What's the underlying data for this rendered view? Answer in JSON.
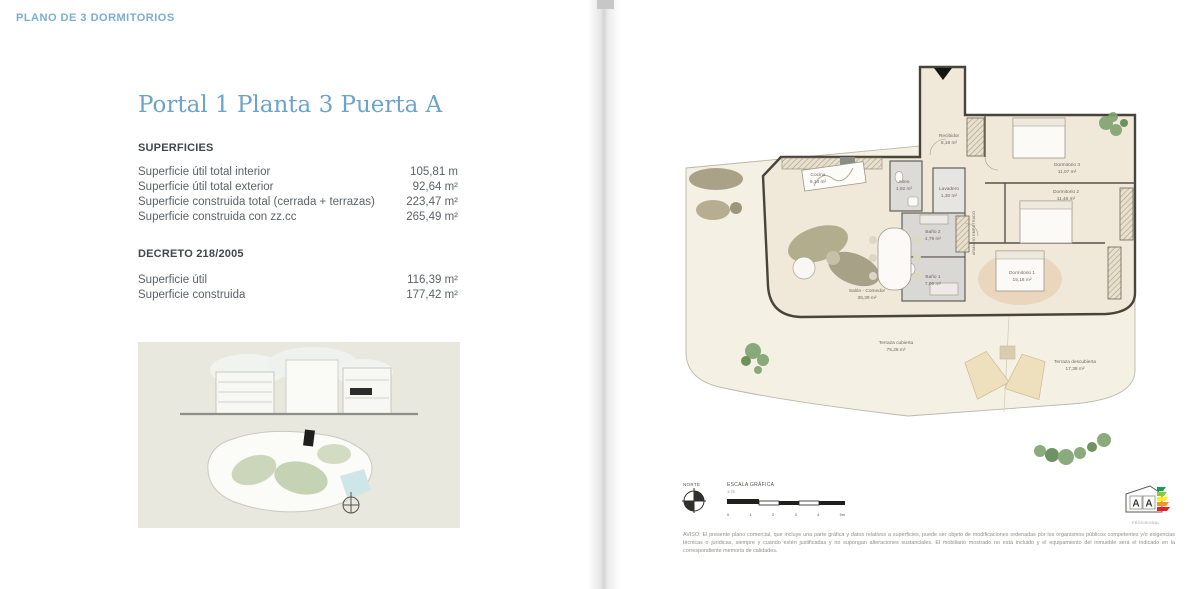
{
  "page": {
    "header": "PLANO DE 3 DORMITORIOS",
    "title": "Portal 1 Planta 3 Puerta A"
  },
  "superficies": {
    "heading": "SUPERFICIES",
    "rows": [
      {
        "label": "Superficie útil total interior",
        "value": "105,81 m"
      },
      {
        "label": "Superficie útil total exterior",
        "value": "92,64 m²"
      },
      {
        "label": "Superficie construida total (cerrada + terrazas)",
        "value": "223,47 m²"
      },
      {
        "label": "Superficie construida con zz.cc",
        "value": "265,49 m²"
      }
    ]
  },
  "decreto": {
    "heading": "DECRETO 218/2005",
    "rows": [
      {
        "label": "Superficie útil",
        "value": "116,39 m²"
      },
      {
        "label": "Superficie construida",
        "value": "177,42 m²"
      }
    ]
  },
  "plan": {
    "rooms": [
      {
        "name": "Recibidor",
        "area": "8,18 m²"
      },
      {
        "name": "Cocina",
        "area": "9,14 m²"
      },
      {
        "name": "Aseo",
        "area": "1,92 m²"
      },
      {
        "name": "Lavadero",
        "area": "1,30 m²"
      },
      {
        "name": "Baño 2",
        "area": "4,79 m²"
      },
      {
        "name": "Baño 1",
        "area": "7,06 m²"
      },
      {
        "name": "Salón - Comedor",
        "area": "35,39 m²"
      },
      {
        "name": "Dormitorio 1",
        "area": "15,16 m²"
      },
      {
        "name": "Dormitorio 2",
        "area": "11,46 m²"
      },
      {
        "name": "Dormitorio 3",
        "area": "11,07 m²"
      },
      {
        "name": "Terraza cubierta",
        "area": "75,26 m²"
      },
      {
        "name": "Terraza descubierta",
        "area": "17,38 m²"
      }
    ],
    "shaft_label": "ARMARIO EMPOTRADO"
  },
  "legend": {
    "north_label": "NORTE",
    "scale_label": "ESCALA GRÁFICA",
    "scale_ratio": "1:75",
    "scale_ticks": [
      "0",
      "1",
      "2",
      "3",
      "4",
      "5m"
    ]
  },
  "energy": {
    "letters": [
      "A",
      "A"
    ],
    "caption": "PROVISIONAL",
    "colors": [
      "#00a651",
      "#8dc63f",
      "#fff200",
      "#f7941d",
      "#ed1c24"
    ]
  },
  "disclaimer": "AVISO: El presente plano comercial, que incluye una parte gráfica y datos relativos a superficies, puede ser objeto de modificaciones ordenadas por los organismos públicos competentes y/o exigencias técnicas o jurídicas, siempre y cuando estén justificadas y no supongan alteraciones sustanciales. El mobiliario mostrado no está incluido y el equipamiento del inmueble será el indicado en la correspondiente memoria de calidades."
}
